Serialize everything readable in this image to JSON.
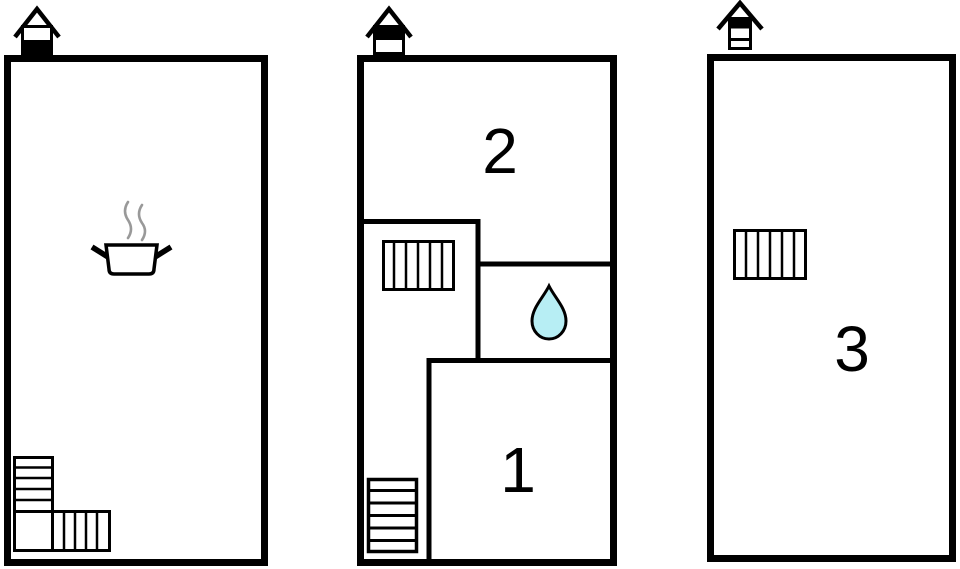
{
  "colors": {
    "wall": "#000000",
    "background": "#ffffff",
    "water_drop_fill": "#b7eef4",
    "steam": "#999999"
  },
  "floor_plans": [
    {
      "name": "ground-floor",
      "storey_indicator": {
        "storeys": 2,
        "highlighted_from_top": 2
      },
      "features": [
        "cooking-pot-with-steam",
        "l-shaped-staircase"
      ],
      "labels": []
    },
    {
      "name": "second-storey",
      "storey_indicator": {
        "storeys": 2,
        "highlighted_from_top": 1
      },
      "features": [
        "staircase-upper",
        "water-drop",
        "staircase-lower"
      ],
      "labels": [
        "2",
        "1"
      ]
    },
    {
      "name": "third-storey",
      "storey_indicator": {
        "storeys": 3,
        "highlighted_from_top": 1
      },
      "features": [
        "staircase"
      ],
      "labels": [
        "3"
      ]
    }
  ]
}
